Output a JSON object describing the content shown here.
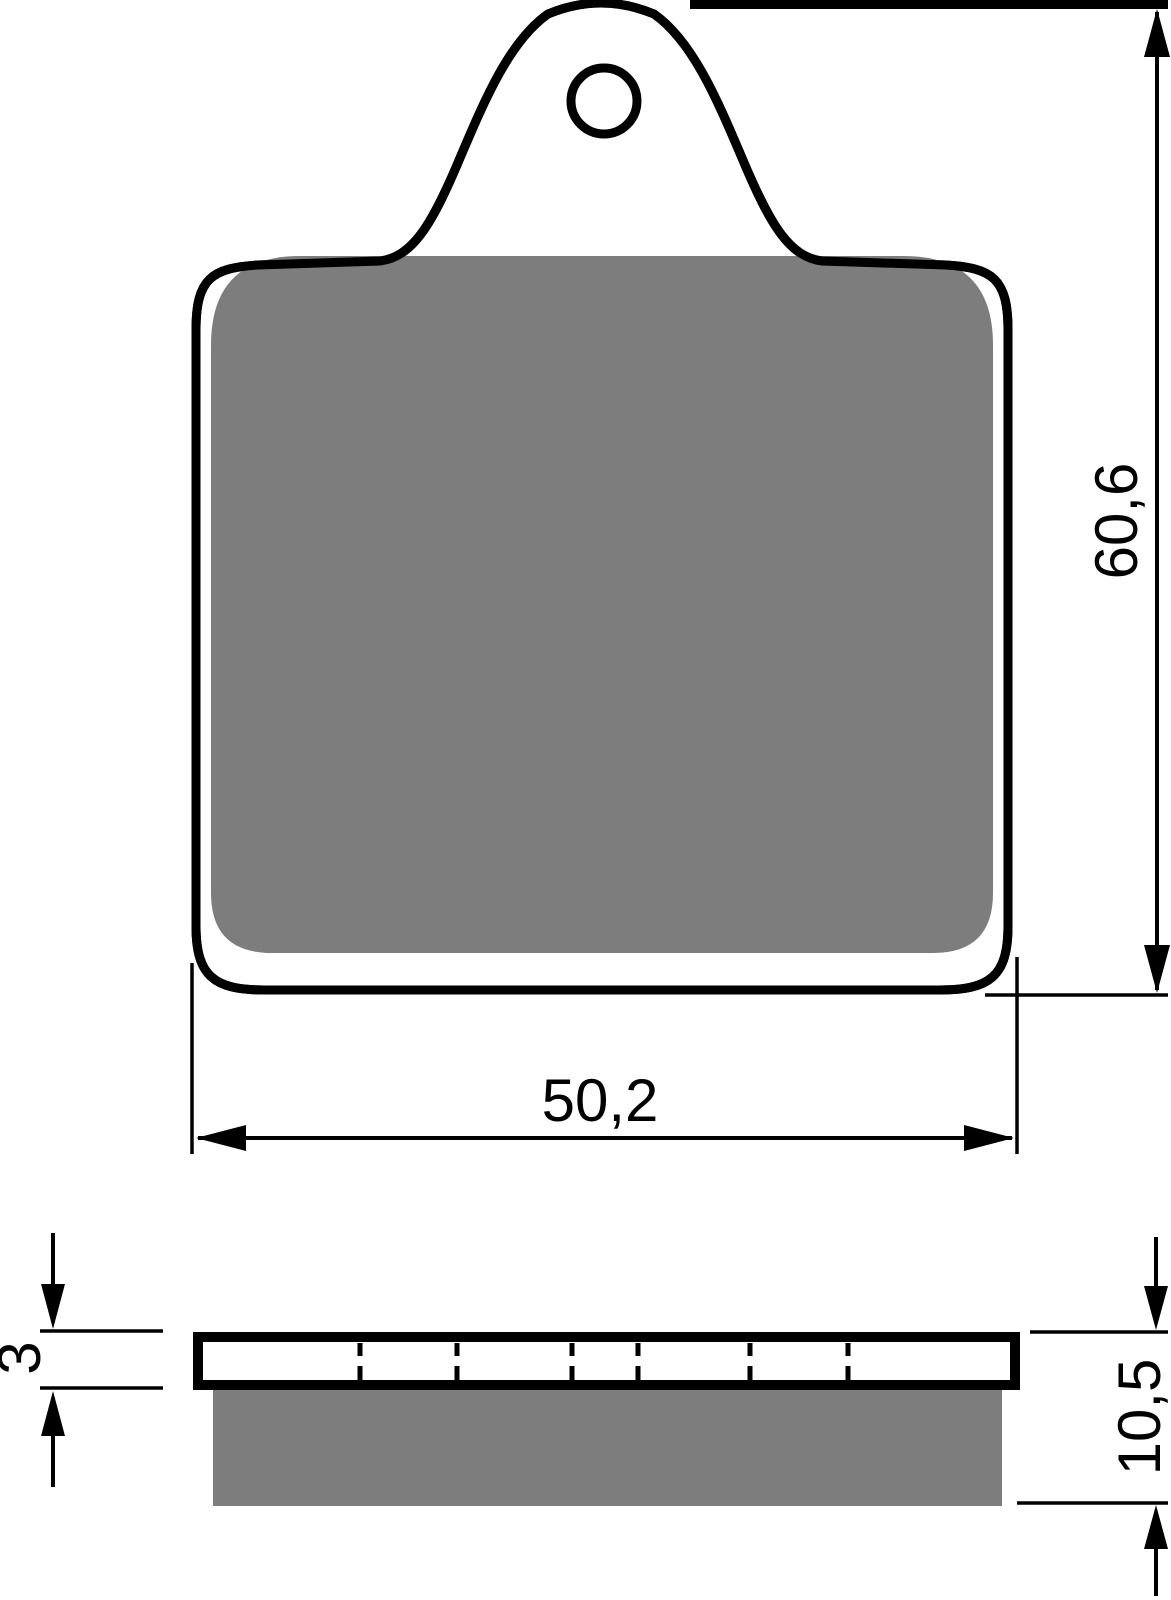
{
  "drawing": {
    "subject": "brake-pad",
    "view_front": "front-view",
    "view_side": "side-profile-view"
  },
  "colors": {
    "line": "#000000",
    "friction_material": "#7d7d7d",
    "background": "#ffffff"
  },
  "dimensions": {
    "pad_height": "60,6",
    "pad_width": "50,2",
    "backplate_thickness": "3",
    "total_thickness": "10,5"
  }
}
